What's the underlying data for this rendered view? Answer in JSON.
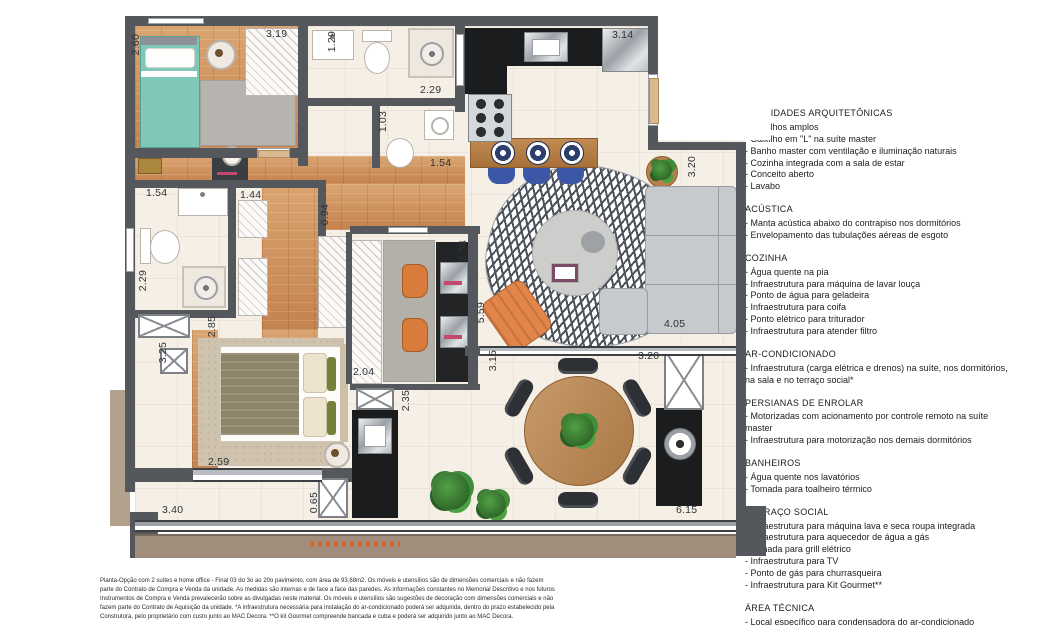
{
  "plan": {
    "dims": [
      "2.60",
      "3.19",
      "1.29",
      "2.29",
      "3.14",
      "1.54",
      "1.03",
      "1.54",
      "2.29",
      "1.44",
      "0.94",
      "3.20",
      "3.25",
      "2.85",
      "2.04",
      "5.59",
      "2.54",
      "3.15",
      "4.05",
      "3.20",
      "2.35",
      "2.59",
      "0.65",
      "3.40",
      "6.15"
    ]
  },
  "info": {
    "sections": [
      {
        "title": "QUALIDADES ARQUITETÔNICAS",
        "items": [
          "Caixilhos amplos",
          "Caixilho em \"L\" na suíte master",
          "Banho master com ventilação e iluminação naturais",
          "Cozinha integrada com a sala de estar",
          "Conceito aberto",
          "Lavabo"
        ]
      },
      {
        "title": "ACÚSTICA",
        "items": [
          "Manta acústica abaixo do contrapiso nos dormitórios",
          "Envelopamento das tubulações aéreas de esgoto"
        ]
      },
      {
        "title": "COZINHA",
        "items": [
          "Água quente na pia",
          "Infraestrutura para máquina de lavar louça",
          "Ponto de água para geladeira",
          "Infraestrutura para coifa",
          "Ponto elétrico para triturador",
          "Infraestrutura para atender filtro"
        ]
      },
      {
        "title": "AR-CONDICIONADO",
        "items": [
          "Infraestrutura (carga elétrica e drenos) na suíte, nos dormitórios, na sala e no terraço social*"
        ]
      },
      {
        "title": "PERSIANAS DE ENROLAR",
        "items": [
          "Motorizadas com acionamento por controle remoto na suíte master",
          "Infraestrutura para motorização nos demais dormitórios"
        ]
      },
      {
        "title": "BANHEIROS",
        "items": [
          "Água quente nos lavatórios",
          "Tomada para toalheiro térmico"
        ]
      },
      {
        "title": "TERRAÇO SOCIAL",
        "items": [
          "Infraestrutura para máquina lava e seca roupa integrada",
          "Infraestrutura para aquecedor de água a gás",
          "Tomada para grill elétrico",
          "Infraestrutura para TV",
          "Ponto de gás para churrasqueira",
          "Infraestrutura para Kit Gourmet**"
        ]
      },
      {
        "title": "ÁREA TÉCNICA",
        "items": [
          "Local específico para condensadora do ar-condicionado"
        ]
      }
    ]
  },
  "footer": {
    "disclaimer": "Planta-Opção com 2 suítes e home office - Final 03 do 3o ao 20o pavimento, com área de 93,68m2. Os móveis e utensílios são de dimensões comerciais e não fazem parte do Contrato de Compra e Venda da unidade. As medidas são internas e de face a face das paredes. As informações constantes no Memorial Descritivo e nos futuros Instrumentos de Compra e Venda prevalecerão sobre as divulgadas neste material. Os móveis e utensílios são sugestões de decoração com dimensões comerciais e não fazem parte do Contrato de Aquisição da unidade. *A infraestrutura necessária para instalação do ar-condicionado poderá ser adquirida, dentro do prazo estabelecido pela Construtora, pelo proprietário com custo junto ao MAC Decora. **O kit Gourmet compreende bancada e cuba e poderá ser adquirido junto ao MAC Decora."
  }
}
